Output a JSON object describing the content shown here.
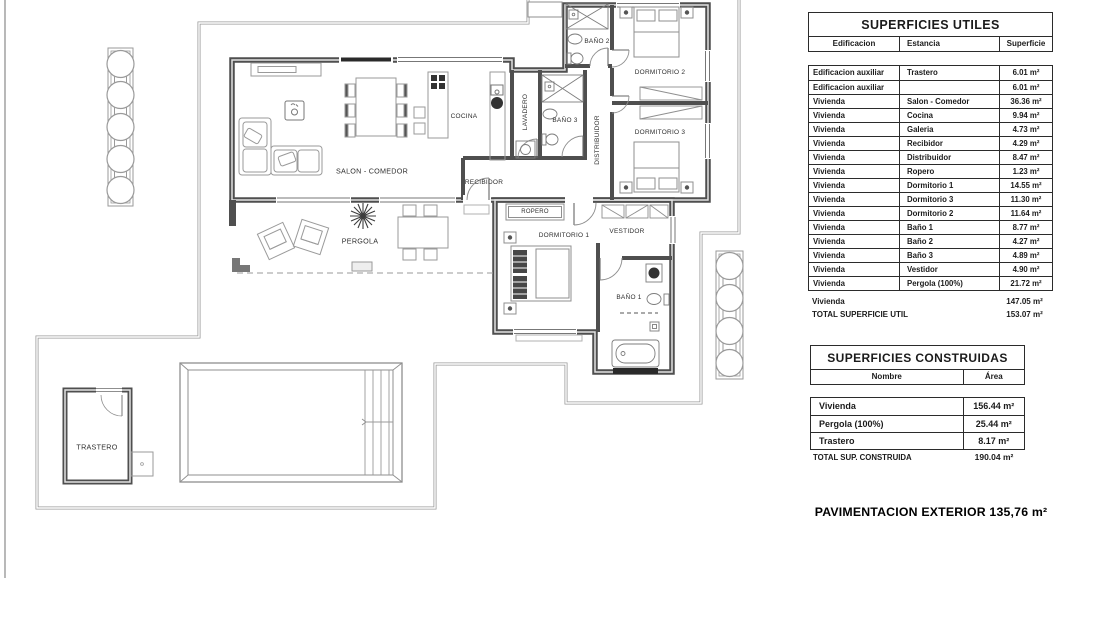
{
  "plan": {
    "rooms": {
      "salon": "SALON - COMEDOR",
      "cocina": "COCINA",
      "lavadero": "LAVADERO",
      "banyo2": "BAÑO 2",
      "banyo3": "BAÑO 3",
      "distribuidor": "DISTRIBUIDOR",
      "dormitorio2": "DORMITORIO 2",
      "dormitorio3": "DORMITORIO 3",
      "recibidor": "RECIBIDOR",
      "ropero": "ROPERO",
      "pergola": "PERGOLA",
      "dormitorio1": "DORMITORIO 1",
      "vestidor": "VESTIDOR",
      "banyo1": "BAÑO 1",
      "trastero": "TRASTERO"
    }
  },
  "tables": {
    "utiles": {
      "title": "SUPERFICIES UTILES",
      "columns": [
        "Edificacion",
        "Estancia",
        "Superficie"
      ],
      "rows": [
        [
          "Edificacion auxiliar",
          "Trastero",
          "6.01 m²"
        ],
        [
          "Edificacion auxiliar",
          "",
          "6.01 m²"
        ],
        [
          "Vivienda",
          "Salon - Comedor",
          "36.36 m²"
        ],
        [
          "Vivienda",
          "Cocina",
          "9.94 m²"
        ],
        [
          "Vivienda",
          "Galeria",
          "4.73 m²"
        ],
        [
          "Vivienda",
          "Recibidor",
          "4.29 m²"
        ],
        [
          "Vivienda",
          "Distribuidor",
          "8.47 m²"
        ],
        [
          "Vivienda",
          "Ropero",
          "1.23 m²"
        ],
        [
          "Vivienda",
          "Dormitorio 1",
          "14.55 m²"
        ],
        [
          "Vivienda",
          "Dormitorio 3",
          "11.30 m²"
        ],
        [
          "Vivienda",
          "Dormitorio 2",
          "11.64 m²"
        ],
        [
          "Vivienda",
          "Baño 1",
          "8.77 m²"
        ],
        [
          "Vivienda",
          "Baño 2",
          "4.27 m²"
        ],
        [
          "Vivienda",
          "Baño 3",
          "4.89 m²"
        ],
        [
          "Vivienda",
          "Vestidor",
          "4.90 m²"
        ],
        [
          "Vivienda",
          "Pergola  (100%)",
          "21.72 m²"
        ]
      ],
      "subtotal_label": "Vivienda",
      "subtotal_value": "147.05 m²",
      "total_label": "TOTAL SUPERFICIE UTIL",
      "total_value": "153.07 m²"
    },
    "construidas": {
      "title": "SUPERFICIES CONSTRUIDAS",
      "columns": [
        "Nombre",
        "Área"
      ],
      "rows": [
        [
          "Vivienda",
          "156.44 m²"
        ],
        [
          "Pergola  (100%)",
          "25.44 m²"
        ],
        [
          "Trastero",
          "8.17 m²"
        ]
      ],
      "total_label": "TOTAL SUP. CONSTRUIDA",
      "total_value": "190.04 m²"
    }
  },
  "footer": {
    "pavimentacion": "PAVIMENTACION EXTERIOR 135,76 m²"
  }
}
